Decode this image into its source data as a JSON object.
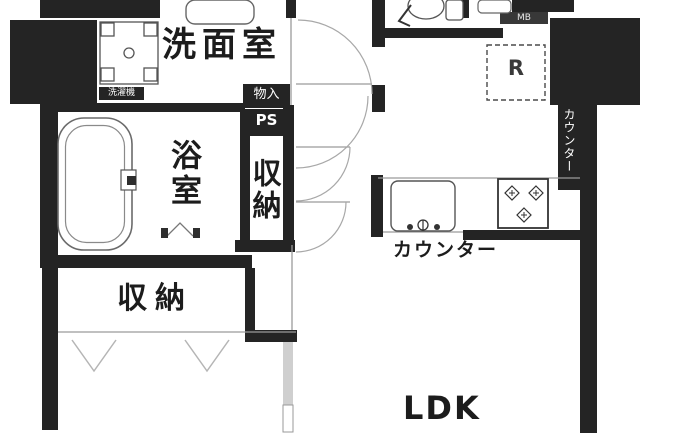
{
  "labels": {
    "washroom": "洗面室",
    "bathroom": "浴室",
    "hall_closet": "収納",
    "storage": "物入",
    "pipe_space": "PS",
    "bottom_closet": "収納",
    "kitchen_counter": "カウンター",
    "side_counter": "カウンター",
    "washer_space": "洗濯機",
    "refrigerator": "R",
    "meter_box": "MB",
    "ldk": "LDK"
  },
  "colors": {
    "wall": "#242424",
    "line": "#9a9a9a",
    "text": "#1c1c1c"
  }
}
